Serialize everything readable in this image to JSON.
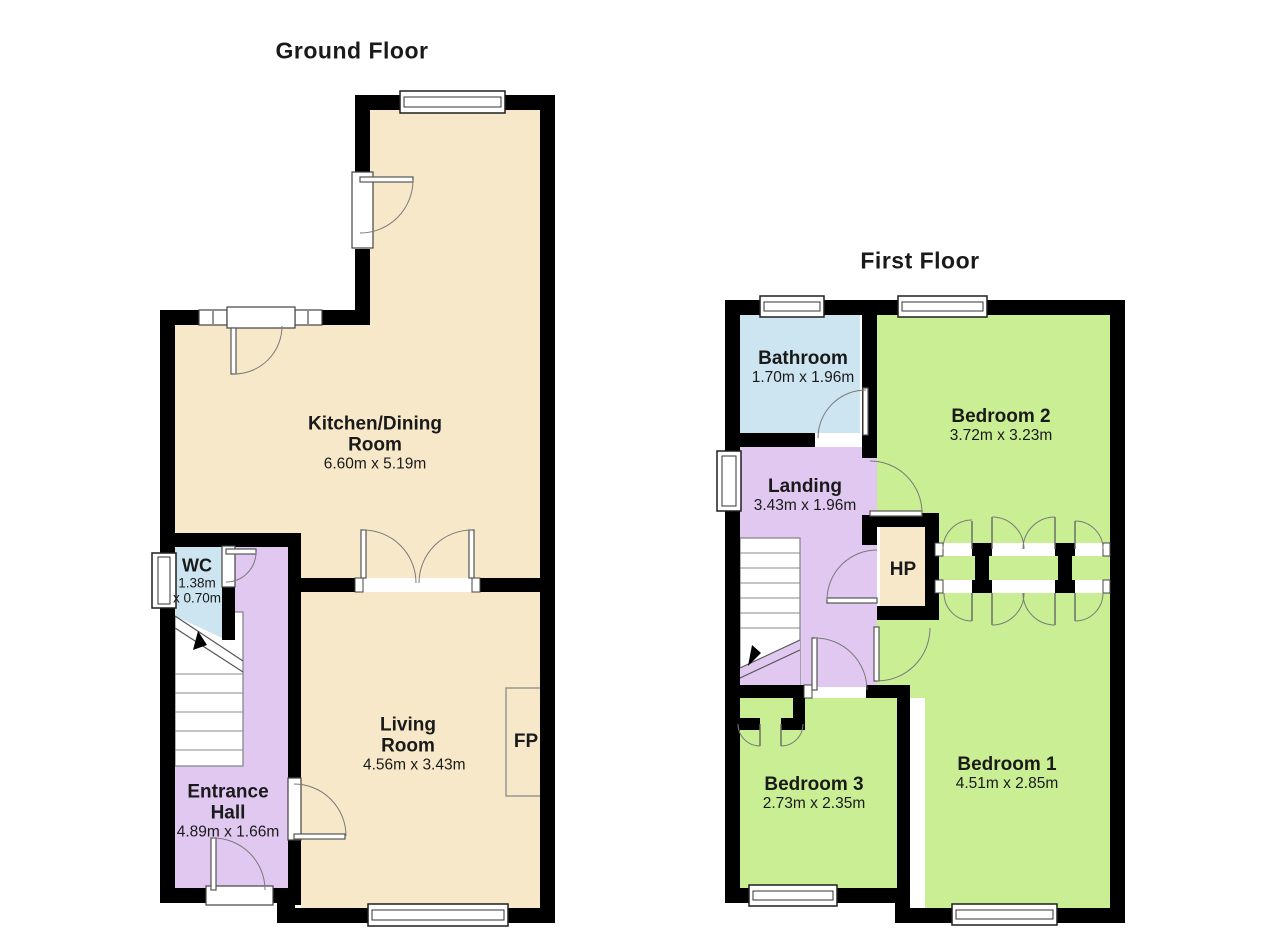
{
  "colors": {
    "cream": "#F7E8C9",
    "blue": "#CDE4F1",
    "purple": "#E0C8F0",
    "green": "#C9EE93",
    "wall": "#000000"
  },
  "ground_floor": {
    "title": "Ground Floor",
    "rooms": {
      "kitchen": {
        "name": "Kitchen/Dining Room",
        "dims": "6.60m x 5.19m"
      },
      "wc": {
        "name": "WC",
        "dims_line1": "1.38m",
        "dims_line2": "x 0.70m"
      },
      "entrance_hall": {
        "name": "Entrance Hall",
        "dims": "4.89m x 1.66m"
      },
      "living_room": {
        "name": "Living Room",
        "dims": "4.56m x 3.43m"
      },
      "fireplace": {
        "label": "FP"
      }
    }
  },
  "first_floor": {
    "title": "First Floor",
    "rooms": {
      "bathroom": {
        "name": "Bathroom",
        "dims": "1.70m x 1.96m"
      },
      "bedroom2": {
        "name": "Bedroom 2",
        "dims": "3.72m x 3.23m"
      },
      "landing": {
        "name": "Landing",
        "dims": "3.43m x 1.96m"
      },
      "hot_press": {
        "name": "HP"
      },
      "bedroom3": {
        "name": "Bedroom 3",
        "dims": "2.73m x 2.35m"
      },
      "bedroom1": {
        "name": "Bedroom 1",
        "dims": "4.51m x 2.85m"
      }
    }
  }
}
